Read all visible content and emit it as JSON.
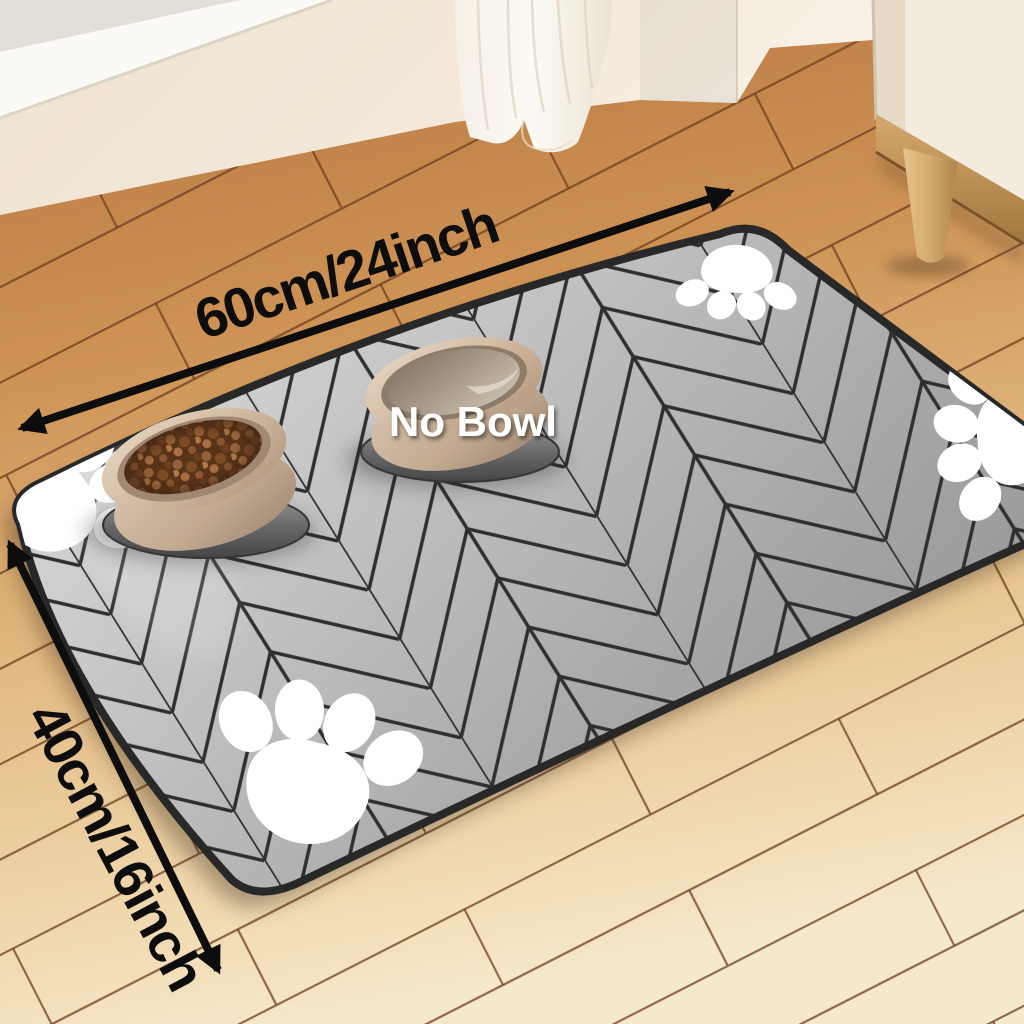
{
  "photo": {
    "description": "Pet feeding mat product photo with dimension annotations",
    "annotations": {
      "width_label": "60cm/24inch",
      "height_label": "40cm/16inch",
      "no_bowl_label": "No Bowl"
    },
    "colors": {
      "annotation_black": "#0d0d0d",
      "no_bowl_text": "#ffffff",
      "mat_gray_light": "#d9d9d9",
      "mat_gray_dark": "#8f8f8f",
      "mat_pattern_line": "#2f2f2f",
      "mat_edge": "#282828",
      "paw_white": "#ffffff",
      "floor_warm_wood": "#c08048",
      "floor_pale_wood": "#f4e6c8",
      "floor_seam": "#6b3c1d",
      "wall_cream": "#f1e4d3",
      "window_sill_white": "#fcfaf6",
      "curtain_white": "#faf6ef",
      "cabinet_cream": "#f3ecdf",
      "cabinet_rail_wood": "#c89a63",
      "cabinet_leg_wood": "#d8b27c",
      "bowl_beige": "#c9b199",
      "kibble_brown": "#7c4b26",
      "water_beige": "#b3a391",
      "tray_gray": "#5a5a5a"
    }
  }
}
